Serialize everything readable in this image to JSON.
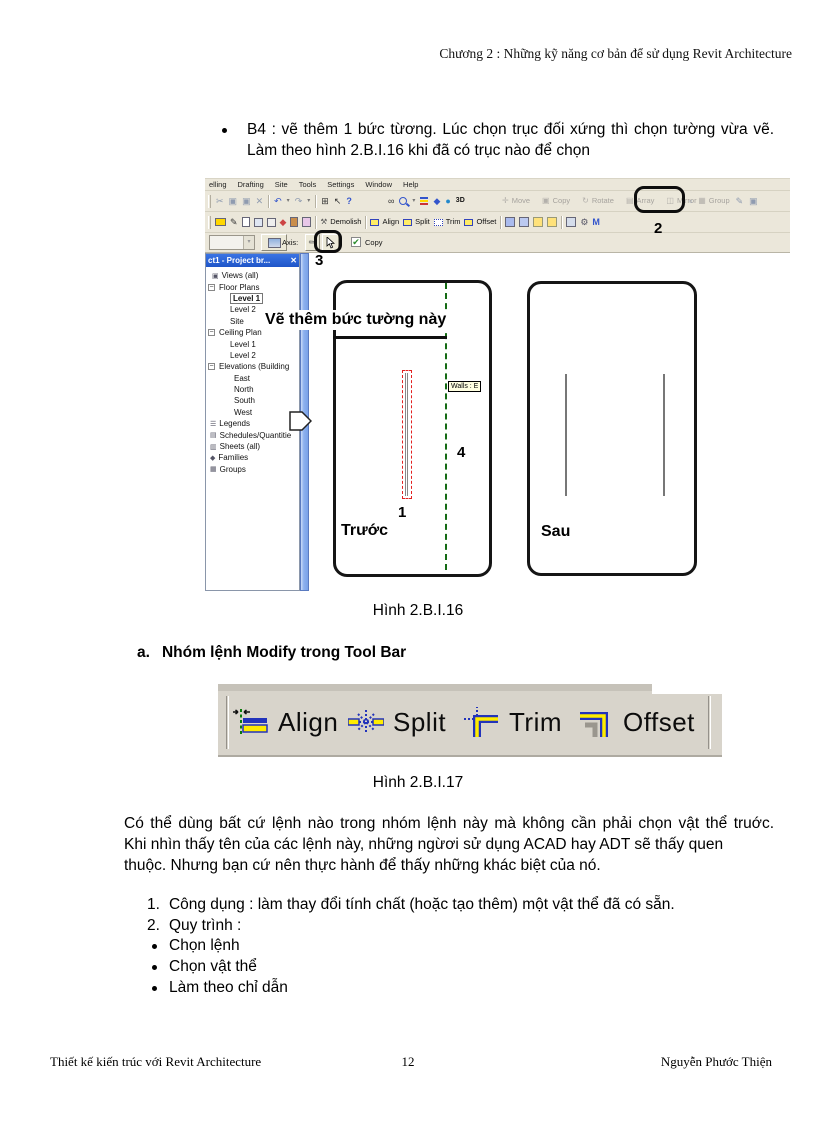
{
  "header": {
    "text": "Chương 2 : Những kỹ năng cơ bản để sử dụng Revit Architecture"
  },
  "intro": {
    "bullet_lines": [
      "B4 : vẽ thêm 1 bức từơng. Lúc chọn trục đối xứng thì chọn tường vừa vẽ.",
      "Làm theo hình 2.B.I.16 khi đã có trục nào để chọn"
    ]
  },
  "revit": {
    "menu_items": [
      "elling",
      "Drafting",
      "Site",
      "Tools",
      "Settings",
      "Window",
      "Help"
    ],
    "toolbar_view_3d_label": "3D",
    "toolbar_disabled_buttons": [
      "Move",
      "Copy",
      "Rotate",
      "Array",
      "Mirror"
    ],
    "toolbar_group_label": "Group",
    "toolbar2_buttons": [
      "Demolish",
      "Align",
      "Split",
      "Trim",
      "Offset"
    ],
    "icon_glyphs": {
      "cut": "✂",
      "copy_doc": "▣",
      "paste": "▣",
      "delete": "✕",
      "undo": "↶",
      "redo": "↷",
      "dropdown": "▾",
      "window": "⊞",
      "help_arrow": "↖",
      "help_q": "?",
      "spectacles": "∞",
      "cube": "◆",
      "globe": "●",
      "hammer": "⚒",
      "pencil": "✎",
      "check": "✔",
      "close": "✕",
      "expander": "−",
      "gear": "⚙",
      "m_tool": "M",
      "disabled_icons": [
        "✛",
        "▣",
        "↻",
        "▤",
        "◫"
      ],
      "after_mirror": "▫",
      "group_icon": "▦",
      "pin1": "✎",
      "pin2": "▣"
    },
    "options_bar": {
      "axis_label": "Axis:",
      "copy_checkbox_label": "Copy",
      "copy_checked": true
    },
    "project_browser": {
      "title": "ct1 - Project br...",
      "tree": [
        {
          "label": "Views (all)",
          "pad": 5,
          "glyph": "▣",
          "icon": "views-icon"
        },
        {
          "label": "Floor Plans",
          "pad": 1,
          "expander": true
        },
        {
          "label": "Level 1",
          "pad": 23,
          "selected": true
        },
        {
          "label": "Level 2",
          "pad": 23
        },
        {
          "label": "Site",
          "pad": 23
        },
        {
          "label": "Ceiling Plan",
          "pad": 1,
          "expander": true
        },
        {
          "label": "Level 1",
          "pad": 23
        },
        {
          "label": "Level 2",
          "pad": 23
        },
        {
          "label": "Elevations (Building",
          "pad": 1,
          "expander": true
        },
        {
          "label": "East",
          "pad": 27
        },
        {
          "label": "North",
          "pad": 27
        },
        {
          "label": "South",
          "pad": 27
        },
        {
          "label": "West",
          "pad": 27
        },
        {
          "label": "Legends",
          "pad": 3,
          "glyph": "☰",
          "icon": "legends-icon"
        },
        {
          "label": "Schedules/Quantitie",
          "pad": 3,
          "glyph": "▤",
          "icon": "schedules-icon"
        },
        {
          "label": "Sheets (all)",
          "pad": 3,
          "glyph": "▥",
          "icon": "sheets-icon"
        },
        {
          "label": "Families",
          "pad": 3,
          "glyph": "◆",
          "icon": "families-icon"
        },
        {
          "label": "Groups",
          "pad": 3,
          "glyph": "▦",
          "icon": "groups-icon"
        }
      ]
    },
    "canvas": {
      "annotation": "Vẽ thêm bức tường này",
      "tooltip": "Walls : E",
      "before_label": "Trước",
      "after_label": "Sau",
      "step1": "1",
      "step2": "2",
      "step3": "3",
      "step4": "4"
    }
  },
  "figures": {
    "fig16": "Hình 2.B.I.16",
    "fig17": "Hình 2.B.I.17"
  },
  "section_a": {
    "marker": "a.",
    "title": "Nhóm lệnh Modify trong Tool Bar"
  },
  "modify_toolbar": {
    "buttons": [
      {
        "label": "Align",
        "icon": "align-icon"
      },
      {
        "label": "Split",
        "icon": "split-icon"
      },
      {
        "label": "Trim",
        "icon": "trim-icon"
      },
      {
        "label": "Offset",
        "icon": "offset-icon"
      }
    ]
  },
  "body": {
    "paragraph_lines": [
      "Có thể dùng bất cứ lệnh nào trong nhóm lệnh này mà không cần phải chọn vật thể truớc.",
      "Khi nhìn thấy tên của các lệnh này, những ngừơi sử dụng ACAD hay ADT sẽ thấy quen",
      "thuộc. Nhưng bạn cứ nên thực hành để thấy những khác biệt của nó."
    ],
    "numbered_markers": [
      "1.",
      "2."
    ],
    "numbered_items": [
      "Công dụng : làm thay đổi tính chất (hoặc tạo thêm) một vật thể đã có sẵn.",
      "Quy trình :"
    ],
    "bullet_items": [
      "Chọn lệnh",
      "Chọn vật thể",
      "Làm theo chỉ dẫn"
    ]
  },
  "footer": {
    "left": "Thiết kế kiến trúc với Revit Architecture",
    "page_number": "12",
    "right": "Nguyễn Phước Thiện"
  },
  "colors": {
    "xp_toolbar_bg": "#ebe7da",
    "browser_title_blue": "#2a63d8",
    "axis_green": "#156b15",
    "selection_red": "#e22020",
    "tooltip_yellow": "#ffffe1",
    "icon_yellow": "#ffec66",
    "icon_blue": "#2233bb"
  }
}
